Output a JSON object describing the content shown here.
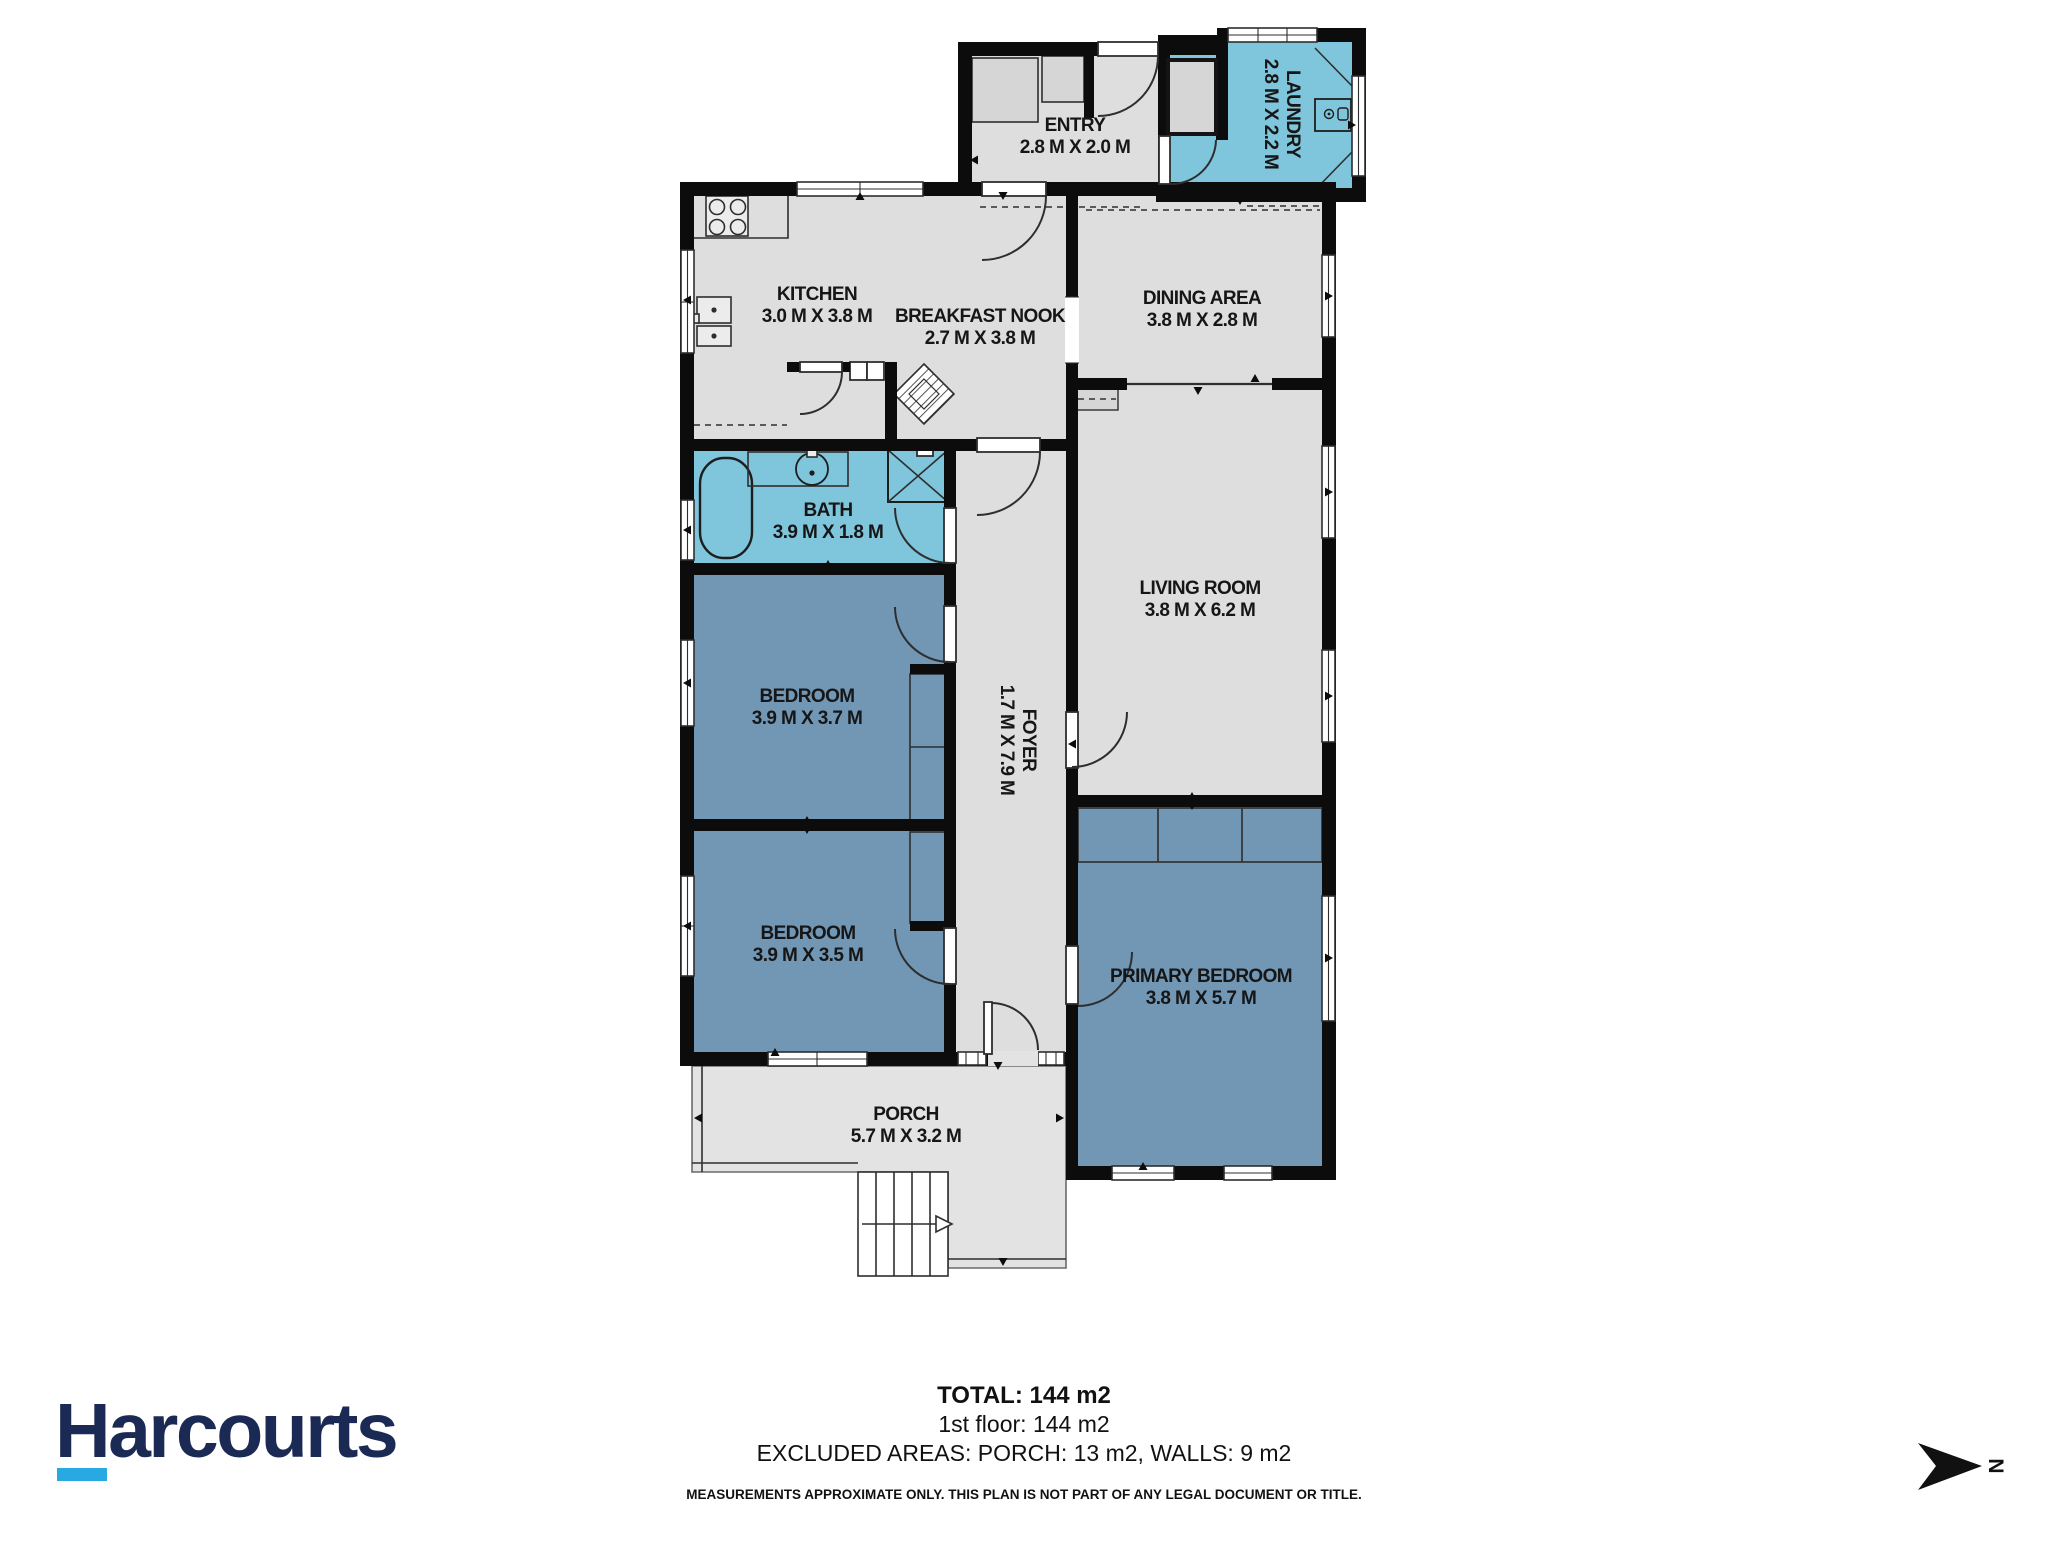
{
  "document": {
    "type": "floor-plan",
    "brand": "Harcourts",
    "compass_label": "N"
  },
  "colors": {
    "wall": "#0c0c0c",
    "floor_gray": "#dedede",
    "wet_cyan": "#7fc5dc",
    "bedroom_blue": "#7197b5",
    "closet_gray": "#d6d6d6",
    "navy": "#1b2a55",
    "accent": "#29a9e1"
  },
  "rooms": {
    "entry": {
      "name": "ENTRY",
      "dims": "2.8 M X 2.0 M"
    },
    "laundry": {
      "name": "LAUNDRY",
      "dims": "2.8 M X 2.2 M"
    },
    "kitchen": {
      "name": "KITCHEN",
      "dims": "3.0 M X 3.8 M"
    },
    "nook": {
      "name": "BREAKFAST NOOK",
      "dims": "2.7 M X 3.8 M"
    },
    "dining": {
      "name": "DINING AREA",
      "dims": "3.8 M X 2.8 M"
    },
    "bath": {
      "name": "BATH",
      "dims": "3.9 M X 1.8 M"
    },
    "living": {
      "name": "LIVING ROOM",
      "dims": "3.8 M X 6.2 M"
    },
    "foyer": {
      "name": "FOYER",
      "dims": "1.7 M X 7.9 M"
    },
    "bedroom1": {
      "name": "BEDROOM",
      "dims": "3.9 M X 3.7 M"
    },
    "bedroom2": {
      "name": "BEDROOM",
      "dims": "3.9 M X 3.5 M"
    },
    "primary": {
      "name": "PRIMARY BEDROOM",
      "dims": "3.8 M X 5.7 M"
    },
    "porch": {
      "name": "PORCH",
      "dims": "5.7 M X 3.2 M"
    }
  },
  "summary": {
    "total": "TOTAL: 144 m2",
    "floor": "1st floor: 144 m2",
    "excluded": "EXCLUDED AREAS: PORCH: 13 m2, WALLS: 9 m2",
    "disclaimer": "MEASUREMENTS APPROXIMATE ONLY. THIS PLAN IS NOT PART OF ANY LEGAL DOCUMENT OR TITLE."
  }
}
